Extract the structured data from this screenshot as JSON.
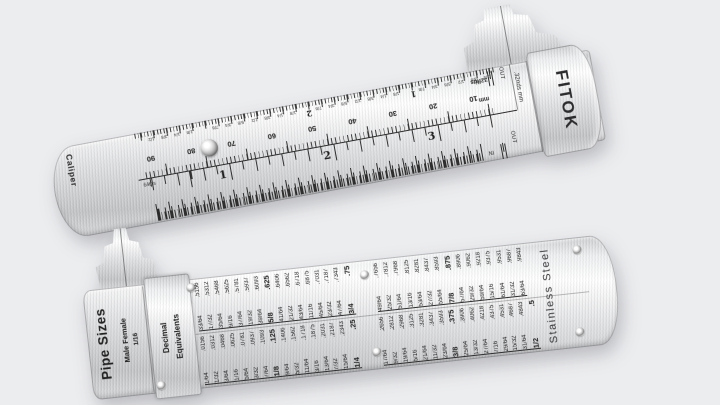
{
  "scene": {
    "background_color": "#ecedef",
    "description": "FITOK stainless steel pocket caliper and pipe size decimal-equivalents gauge"
  },
  "caliper": {
    "side_label": "Caliper",
    "brand": "FITOK",
    "slider_end_label": ".32nds mm",
    "inch_scale": {
      "unit_label": "64ths",
      "numbers": [
        "1",
        "2",
        "3"
      ]
    },
    "thirtyseconds_scale": {
      "unit_label": "32nds",
      "numbers": [
        "2",
        "1"
      ],
      "eighth_fractions": [
        "1/8",
        "1/4",
        "3/8",
        "1/2",
        "5/8",
        "3/4",
        "7/8"
      ]
    },
    "mm_scale": {
      "unit_label": "mm",
      "numbers": [
        "90",
        "80",
        "70",
        "60",
        "50",
        "40",
        "30",
        "20",
        "10"
      ]
    },
    "marks": {
      "in": "IN",
      "out": "OUT"
    }
  },
  "pipe_gauge": {
    "title": "Pipe Sizes",
    "subtitle": "Male  Female",
    "size_value": "1/16",
    "table_header": "Decimal\nEquivalents",
    "material": "Stainless Steel",
    "bold_fractions": [
      "1/8",
      "1/4",
      "3/8",
      "1/2",
      "5/8",
      "3/4",
      "7/8"
    ],
    "decimal_equivalents": {
      "group_1": [
        [
          "1/64",
          ".0156"
        ],
        [
          "1/32",
          ".0312"
        ],
        [
          "3/64",
          ".0468"
        ],
        [
          "1/16",
          ".0625"
        ],
        [
          "5/64",
          ".0781"
        ],
        [
          "3/32",
          ".0937"
        ],
        [
          "7/64",
          ".1093"
        ],
        [
          "1/8",
          ".125"
        ],
        [
          "9/64",
          ".1406"
        ],
        [
          "5/32",
          ".1562"
        ],
        [
          "11/64",
          ".1718"
        ],
        [
          "3/16",
          ".1875"
        ],
        [
          "13/64",
          ".2031"
        ],
        [
          "7/32",
          ".2187"
        ],
        [
          "15/64",
          ".2343"
        ],
        [
          "1/4",
          ".25"
        ]
      ],
      "group_2": [
        [
          "17/64",
          ".2656"
        ],
        [
          "9/32",
          ".2812"
        ],
        [
          "19/64",
          ".2968"
        ],
        [
          "5/16",
          ".3125"
        ],
        [
          "21/64",
          ".3281"
        ],
        [
          "11/32",
          ".3437"
        ],
        [
          "23/64",
          ".3593"
        ],
        [
          "3/8",
          ".375"
        ],
        [
          "25/64",
          ".3906"
        ],
        [
          "13/32",
          ".4062"
        ],
        [
          "27/64",
          ".4218"
        ],
        [
          "7/16",
          ".4375"
        ],
        [
          "29/64",
          ".4531"
        ],
        [
          "15/32",
          ".4687"
        ],
        [
          "31/64",
          ".4843"
        ],
        [
          "1/2",
          ".5"
        ]
      ],
      "group_3": [
        [
          "33/64",
          ".5156"
        ],
        [
          "17/32",
          ".5312"
        ],
        [
          "35/64",
          ".5468"
        ],
        [
          "9/16",
          ".5625"
        ],
        [
          "37/64",
          ".5781"
        ],
        [
          "19/32",
          ".5937"
        ],
        [
          "39/64",
          ".6093"
        ],
        [
          "5/8",
          ".625"
        ],
        [
          "41/64",
          ".6406"
        ],
        [
          "21/32",
          ".6562"
        ],
        [
          "43/64",
          ".6718"
        ],
        [
          "11/16",
          ".6875"
        ],
        [
          "45/64",
          ".7031"
        ],
        [
          "23/32",
          ".7187"
        ],
        [
          "47/64",
          ".7343"
        ],
        [
          "3/4",
          ".75"
        ]
      ],
      "group_4": [
        [
          "49/64",
          ".7656"
        ],
        [
          "25/32",
          ".7812"
        ],
        [
          "51/64",
          ".7968"
        ],
        [
          "13/16",
          ".8125"
        ],
        [
          "53/64",
          ".8281"
        ],
        [
          "27/32",
          ".8437"
        ],
        [
          "55/64",
          ".8593"
        ],
        [
          "7/8",
          ".875"
        ],
        [
          "57/64",
          ".8906"
        ],
        [
          "29/32",
          ".9062"
        ],
        [
          "59/64",
          ".9218"
        ],
        [
          "15/16",
          ".9375"
        ],
        [
          "61/64",
          ".9531"
        ],
        [
          "31/32",
          ".9687"
        ],
        [
          "63/64",
          ".9843"
        ]
      ]
    }
  }
}
